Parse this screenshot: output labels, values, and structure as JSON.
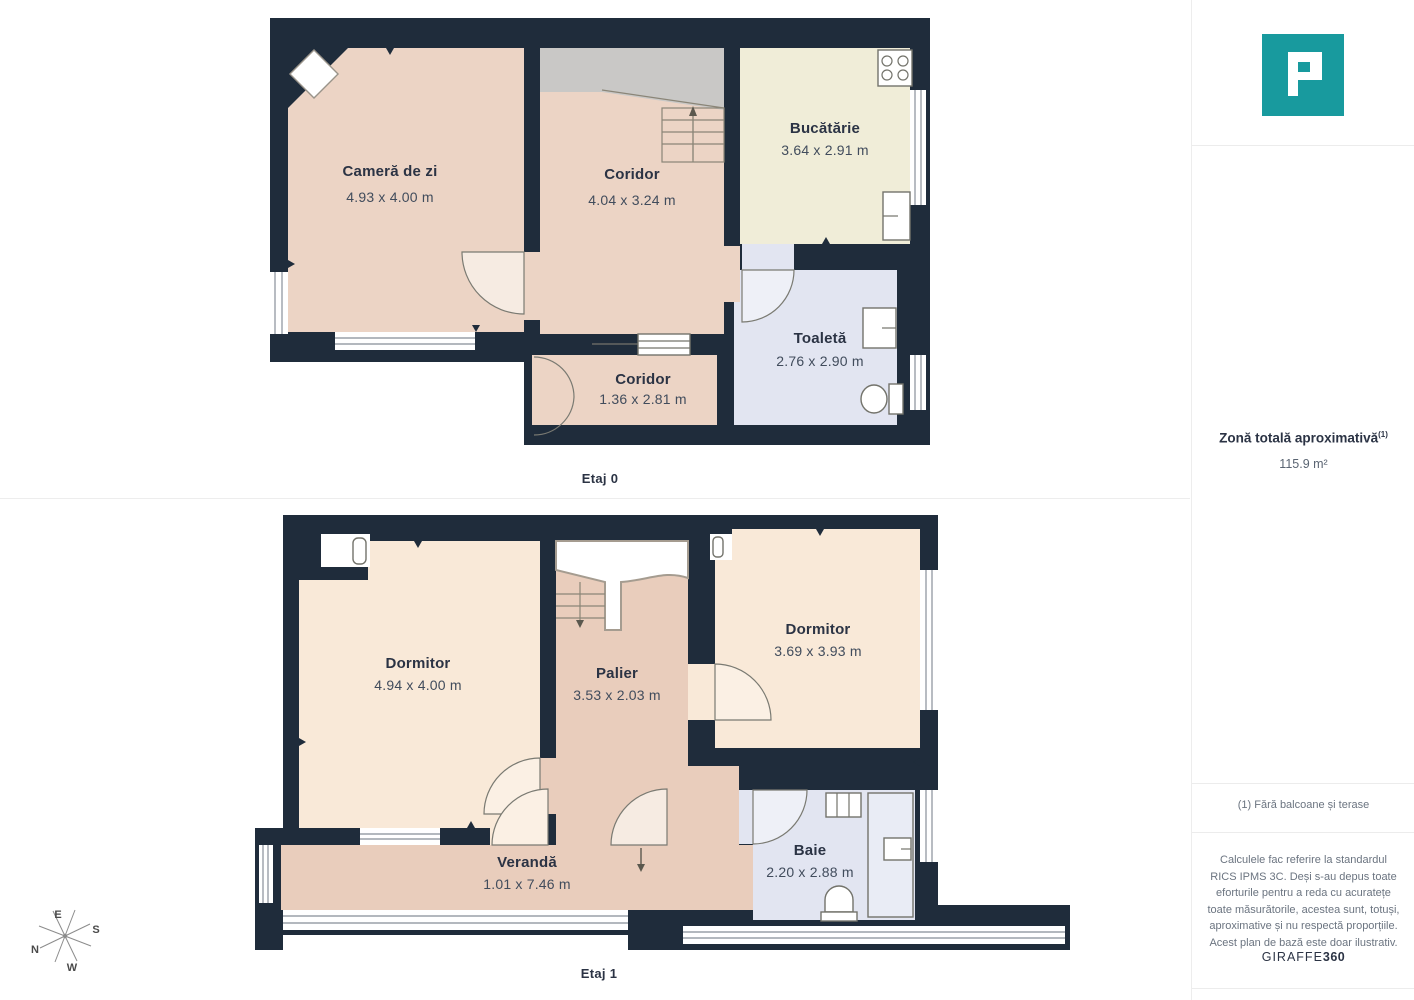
{
  "colors": {
    "wall": "#1f2c3b",
    "room_pink": "#ecd4c5",
    "room_pink_dark": "#e9cdbc",
    "room_peach": "#f9e9d8",
    "room_cream": "#f0edd8",
    "room_blue": "#e2e5f1",
    "stairs_gray": "#c9c8c6",
    "brand_teal": "#189a9e"
  },
  "floorplans": [
    {
      "caption": "Etaj 0",
      "rooms": [
        {
          "name": "Cameră de zi",
          "dims": "4.93 x 4.00 m"
        },
        {
          "name": "Coridor",
          "dims": "4.04 x 3.24 m"
        },
        {
          "name": "Bucătărie",
          "dims": "3.64 x 2.91 m"
        },
        {
          "name": "Toaletă",
          "dims": "2.76 x 2.90 m"
        },
        {
          "name": "Coridor",
          "dims": "1.36 x 2.81 m"
        }
      ]
    },
    {
      "caption": "Etaj 1",
      "rooms": [
        {
          "name": "Dormitor",
          "dims": "4.94 x 4.00 m"
        },
        {
          "name": "Palier",
          "dims": "3.53 x 2.03 m"
        },
        {
          "name": "Dormitor",
          "dims": "3.69 x 3.93 m"
        },
        {
          "name": "Baie",
          "dims": "2.20 x 2.88 m"
        },
        {
          "name": "Verandă",
          "dims": "1.01 x 7.46 m"
        }
      ]
    }
  ],
  "compass": {
    "n": "N",
    "e": "E",
    "s": "S",
    "w": "W"
  },
  "sidebar": {
    "area_title": "Zonă totală aproximativă",
    "area_footnote_marker": "(1)",
    "area_value": "115.9 m²",
    "footnote": "(1) Fără balcoane și terase",
    "disclaimer": "Calculele fac referire la standardul RICS IPMS 3C. Deși s-au depus toate eforturile pentru a reda cu acuratețe toate măsurătorile, acestea sunt, totuși, aproximative și nu respectă proporțiile. Acest plan de bază este doar ilustrativ.",
    "brand_name": "GIRAFFE",
    "brand_suffix": "360"
  }
}
